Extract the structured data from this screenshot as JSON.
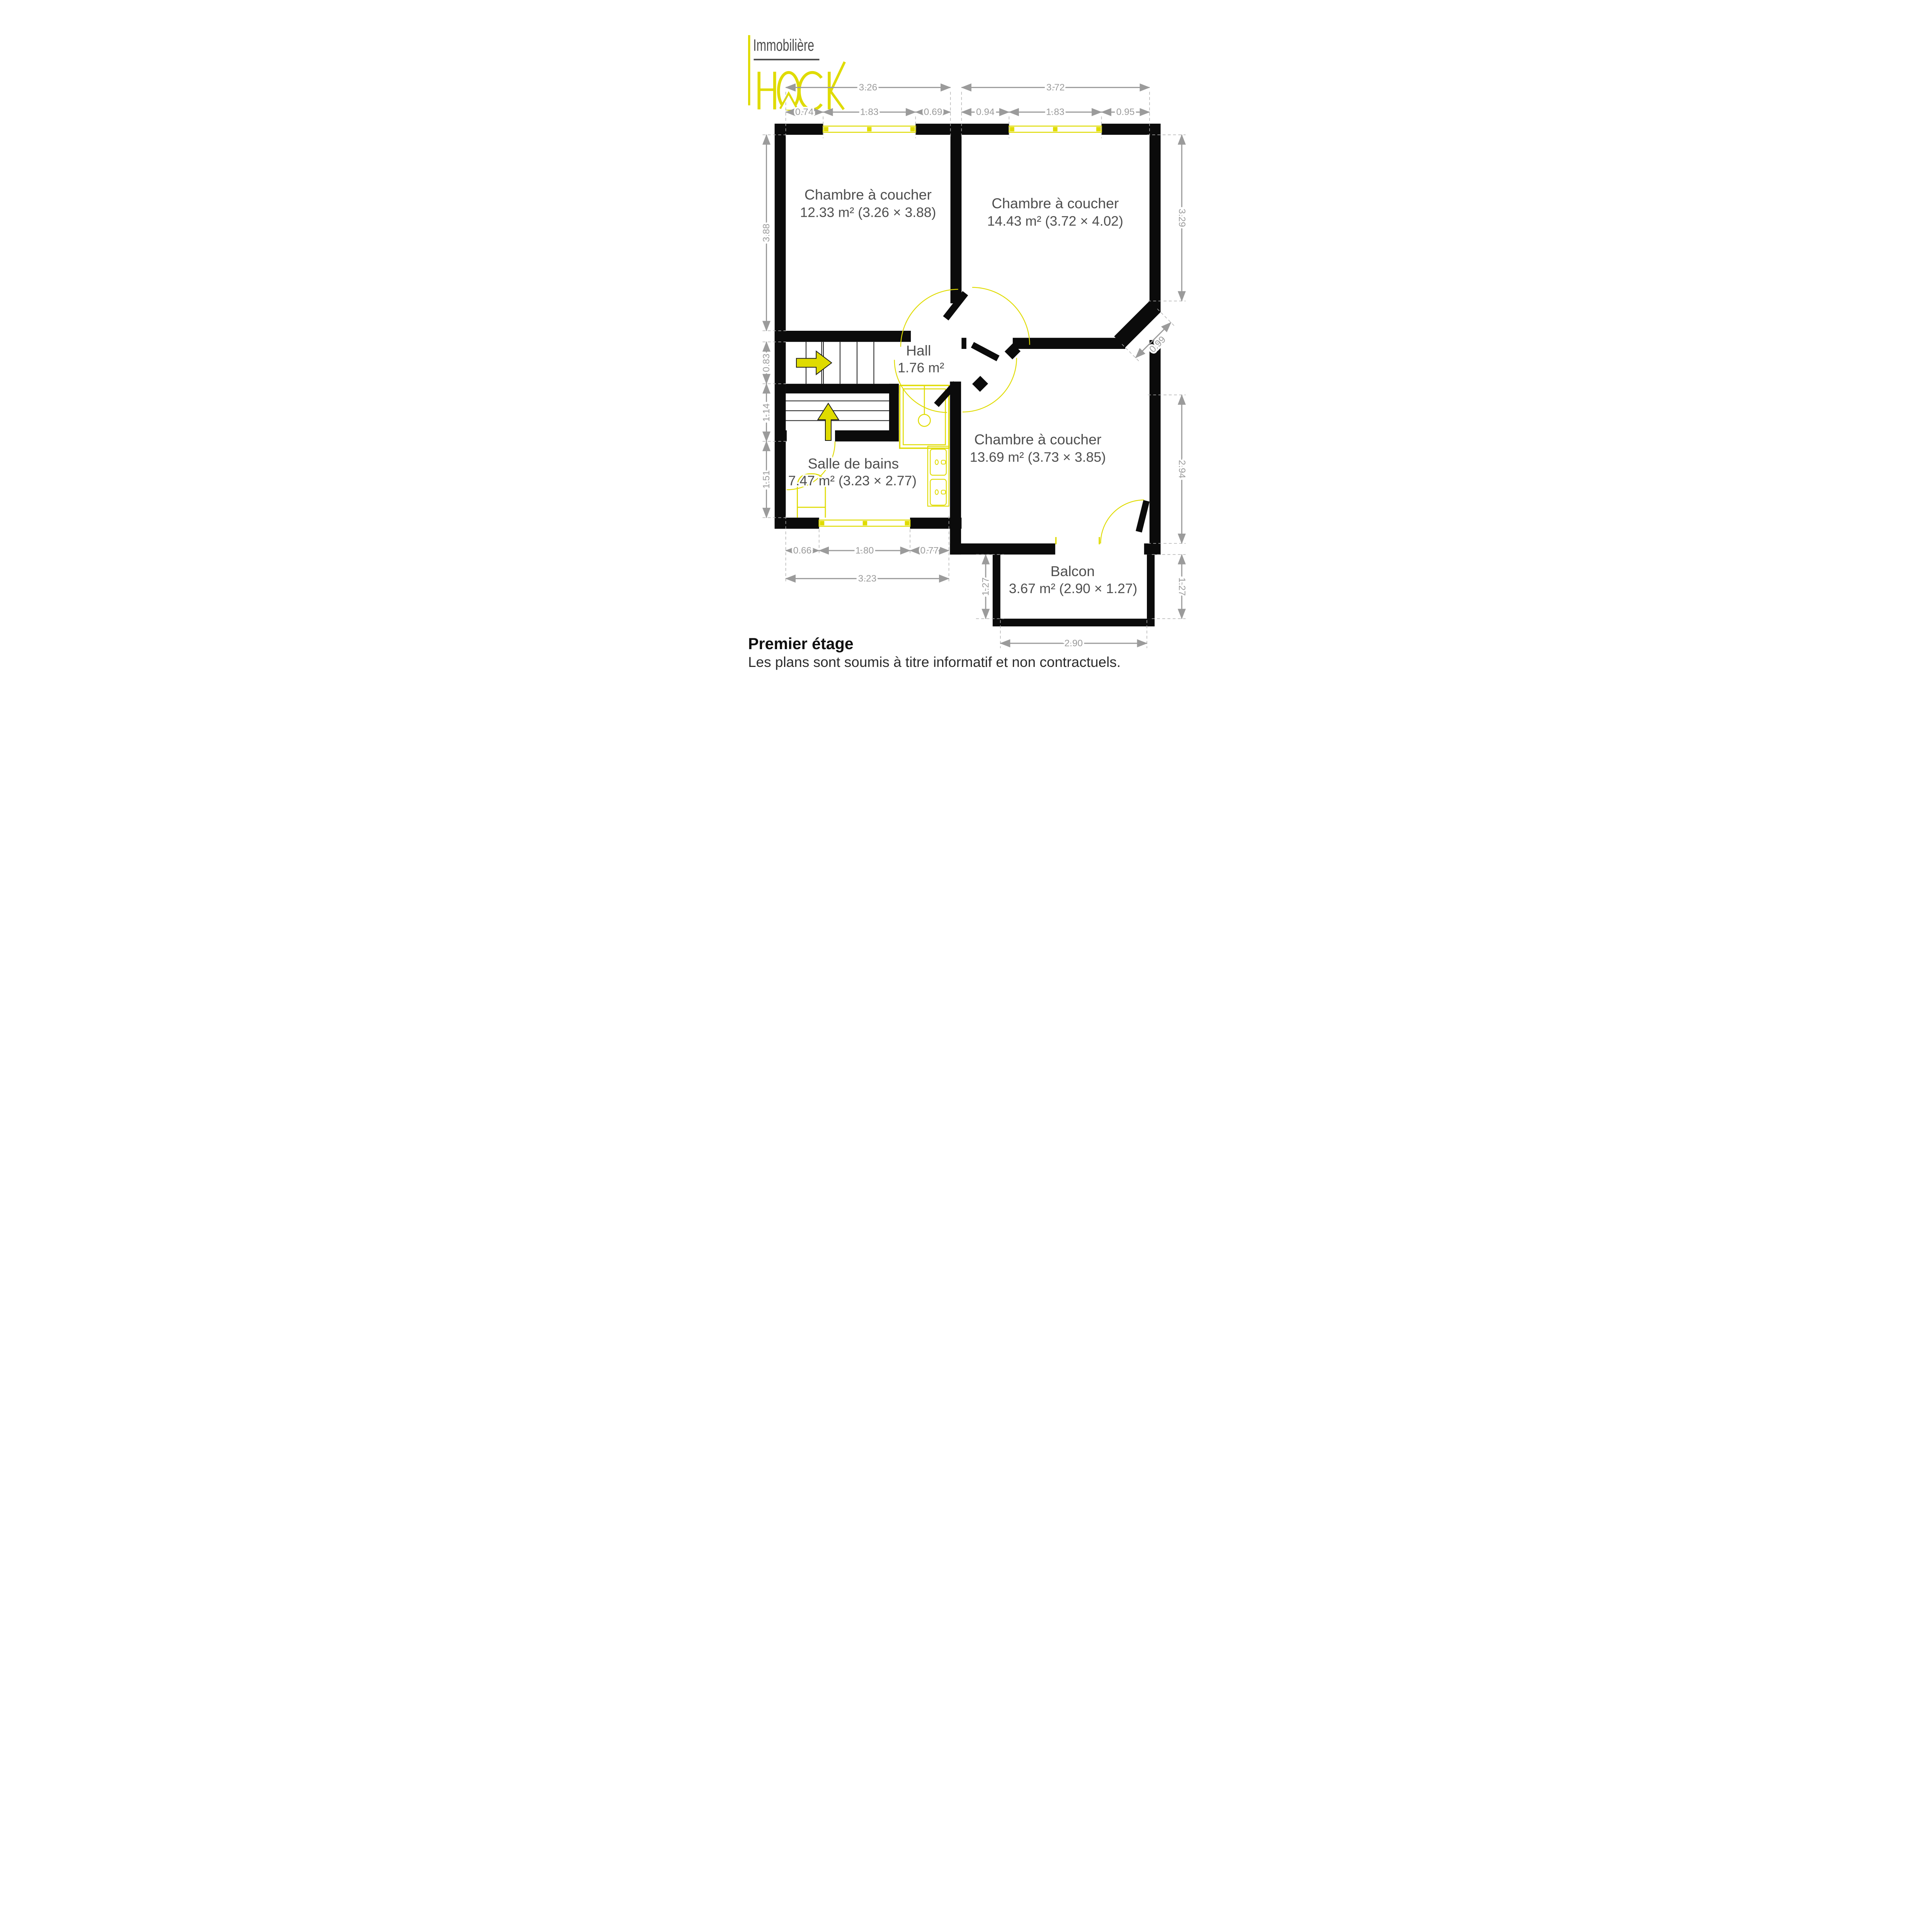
{
  "logo": {
    "tagline": "Immobilière",
    "brand": "HOCK"
  },
  "rooms": {
    "bedroom1": {
      "name": "Chambre à coucher",
      "area": "12.33 m² (3.26 × 3.88)"
    },
    "bedroom2": {
      "name": "Chambre à coucher",
      "area": "14.43 m² (3.72 × 4.02)"
    },
    "bedroom3": {
      "name": "Chambre à coucher",
      "area": "13.69 m² (3.73 × 3.85)"
    },
    "hall": {
      "name": "Hall",
      "area": "1.76 m²"
    },
    "bathroom": {
      "name": "Salle de bains",
      "area": "7.47 m² (3.23 × 2.77)"
    },
    "balcony": {
      "name": "Balcon",
      "area": "3.67 m² (2.90 × 1.27)"
    }
  },
  "dimensions": {
    "top": {
      "left_total": "3.26",
      "left_parts": [
        "0.74",
        "1.83",
        "0.69"
      ],
      "right_total": "3.72",
      "right_parts": [
        "0.94",
        "1.83",
        "0.95"
      ]
    },
    "left": [
      "3.88",
      "0.83",
      "1.14",
      "1.51"
    ],
    "right": [
      "3.29",
      "0.99",
      "2.94",
      "1.27"
    ],
    "bottom": {
      "parts": [
        "0.66",
        "1.80",
        "0.77"
      ],
      "total": "3.23",
      "balcony_height_left": "1.27",
      "balcony_width": "2.90"
    }
  },
  "footer": {
    "title": "Premier étage",
    "disclaimer": "Les plans sont soumis à titre informatif et non contractuels."
  },
  "colors": {
    "accent": "#dfdb00",
    "wall": "#0b0b0b",
    "dimension": "#9b9b9b",
    "label": "#4e4e4e"
  }
}
